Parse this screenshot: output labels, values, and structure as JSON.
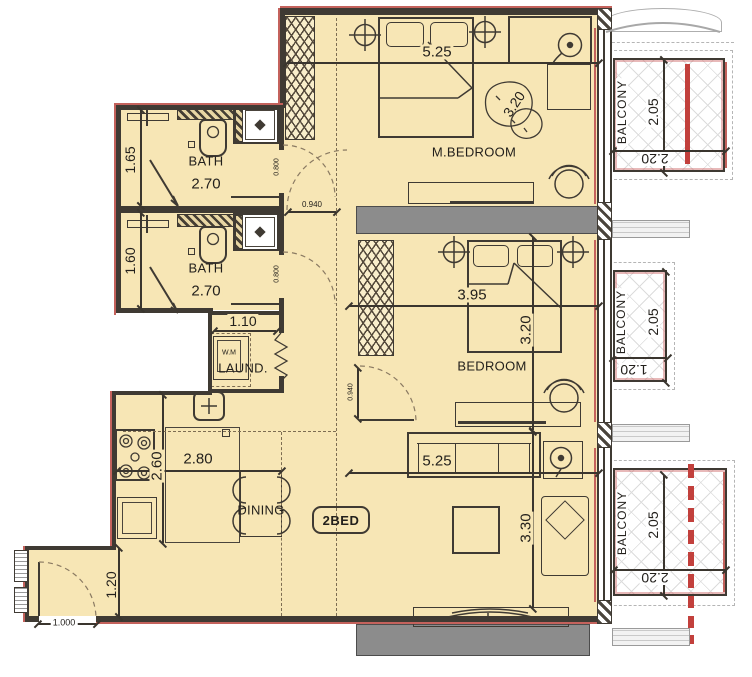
{
  "unit": {
    "badge": "2BED"
  },
  "rooms": {
    "master_bedroom": {
      "label": "M.BEDROOM",
      "width": "5.25",
      "depth": "3.20"
    },
    "bedroom": {
      "label": "BEDROOM",
      "width": "3.95",
      "depth": "3.20"
    },
    "living": {
      "width": "5.25",
      "depth": "3.30"
    },
    "kitchen": {
      "width": "2.80",
      "depth": "2.60"
    },
    "dining": {
      "label": "DINING"
    },
    "bath_top": {
      "label": "BATH",
      "width": "2.70",
      "depth": "1.65"
    },
    "bath_bottom": {
      "label": "BATH",
      "width": "2.70",
      "depth": "1.60"
    },
    "laundry": {
      "label": "LAUND.",
      "appliance": "W.M",
      "width": "1.10"
    },
    "entry": {
      "depth": "1.20"
    },
    "balcony_top": {
      "label": "BALCONY",
      "depth": "2.05",
      "width": "2.20"
    },
    "balcony_middle": {
      "label": "BALCONY",
      "depth": "2.05",
      "width": "1.20"
    },
    "balcony_bottom": {
      "label": "BALCONY",
      "depth": "2.05",
      "width": "2.20"
    }
  },
  "openings": {
    "bath_top_door": "0.800",
    "bath_bottom_door": "0.800",
    "hall_opening": "0.940",
    "bedroom_door": "0.940",
    "entry_door": "1.000"
  },
  "colors": {
    "floor": "#f7e6b5",
    "wall": "#3f3a33",
    "slab": "#8c8c8c",
    "accent_red": "#c2403c",
    "balcony_grid": "#dcdcdc"
  }
}
